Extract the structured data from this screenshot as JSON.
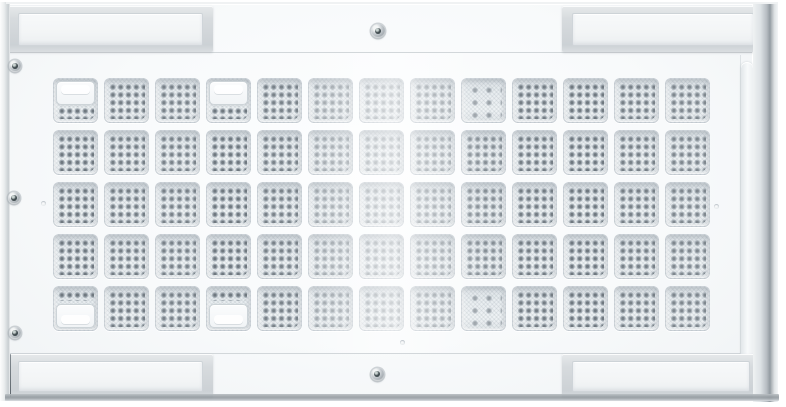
{
  "scene": {
    "type": "product-photo",
    "description": "White perforated metal equipment panel with a 13 by 5 grid of square vented cells, gray mounting bracket bars in each corner, three screws on the left edge and one screw centered at top and bottom",
    "background_color": "#ffffff"
  },
  "colors": {
    "face": "#f8fafb",
    "seam": "#d2d7da",
    "cell_base": "#e7ecef",
    "hole_dark": "#6f787f",
    "hole_ring": "#9aa3ab",
    "bracket_bar": "#d7dbde",
    "bracket_inner": "#f3f5f6",
    "corner_dark": "#5d656c",
    "screw_body": "#ccd1d5",
    "screw_center": "#414c50",
    "bottom_edge": "#949ba0",
    "right_edge": "#939ba1"
  },
  "grid": {
    "rows": 5,
    "cols": 13,
    "cell_size": 45,
    "col_start": 53,
    "col_pitch": 51,
    "row_start": 78,
    "row_pitch": 52,
    "holes_per_cell": "5x5",
    "column_opacity": [
      1,
      0.95,
      0.9,
      1,
      0.9,
      0.62,
      0.55,
      0.62,
      0.78,
      0.95,
      1,
      0.92,
      0.85
    ],
    "special_cells": [
      {
        "row": 1,
        "col": 1,
        "variant": "window-top"
      },
      {
        "row": 1,
        "col": 4,
        "variant": "window-top"
      },
      {
        "row": 1,
        "col": 9,
        "variant": "sparse"
      },
      {
        "row": 5,
        "col": 1,
        "variant": "window-bottom"
      },
      {
        "row": 5,
        "col": 4,
        "variant": "window-bottom"
      },
      {
        "row": 5,
        "col": 9,
        "variant": "sparse"
      }
    ]
  },
  "brackets": [
    {
      "id": "bracket-top-left",
      "x": 8,
      "y": 6,
      "w": 205,
      "h": 46
    },
    {
      "id": "bracket-top-right",
      "x": 562,
      "y": 6,
      "w": 202,
      "h": 46
    },
    {
      "id": "bracket-bottom-left",
      "x": 8,
      "y": 354,
      "w": 205,
      "h": 44
    },
    {
      "id": "bracket-bottom-right",
      "x": 562,
      "y": 354,
      "w": 198,
      "h": 44
    }
  ],
  "corners": [
    {
      "id": "corner-tab-top-left",
      "x": 3,
      "y": 5,
      "w": 7,
      "h": 47
    },
    {
      "id": "corner-tab-top-right",
      "x": 765,
      "y": 3,
      "w": 9,
      "h": 49
    },
    {
      "id": "corner-tab-bottom-left",
      "x": 3,
      "y": 354,
      "w": 8,
      "h": 43
    },
    {
      "id": "corner-tab-bottom-right",
      "x": 762,
      "y": 355,
      "w": 15,
      "h": 44
    }
  ],
  "screws": [
    {
      "id": "screw-top-center",
      "cx": 378,
      "cy": 31,
      "d": 14
    },
    {
      "id": "screw-left-top",
      "cx": 15,
      "cy": 66,
      "d": 12
    },
    {
      "id": "screw-left-middle",
      "cx": 14,
      "cy": 198,
      "d": 12
    },
    {
      "id": "screw-left-bottom",
      "cx": 15,
      "cy": 333,
      "d": 12
    },
    {
      "id": "screw-bottom-center",
      "cx": 377,
      "cy": 374,
      "d": 13
    }
  ],
  "dimples": [
    {
      "cx": 43,
      "cy": 203
    },
    {
      "cx": 716,
      "cy": 206
    },
    {
      "cx": 402,
      "cy": 342
    }
  ]
}
